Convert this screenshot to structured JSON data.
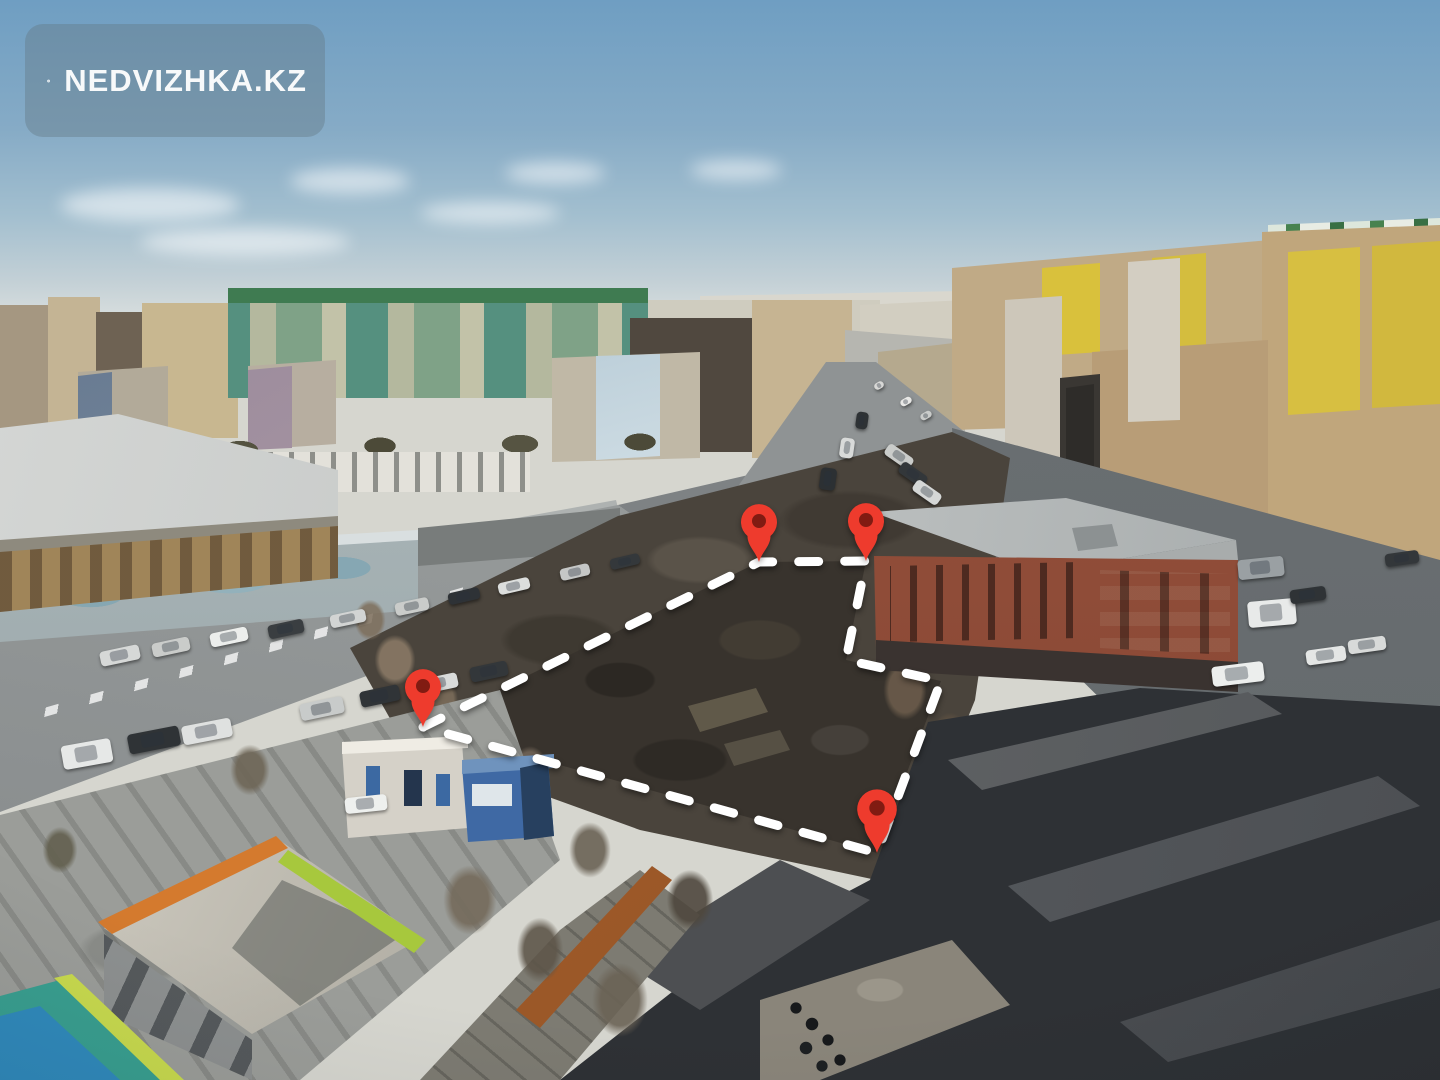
{
  "watermark": {
    "brand_text": "NEDVIZHKA.KZ",
    "icon": "house-icon"
  },
  "plot_overlay": {
    "outline_color": "#ffffff",
    "outline_style": "dashed",
    "stroke_width": 9,
    "dash_pattern": [
      20,
      26
    ],
    "points": [
      [
        423,
        727
      ],
      [
        759,
        562
      ],
      [
        866,
        561
      ],
      [
        846,
        660
      ],
      [
        941,
        681
      ],
      [
        877,
        853
      ]
    ],
    "closed": true,
    "pins": [
      {
        "name": "pin-top-left",
        "x": 759,
        "y": 562,
        "scale": 1.0
      },
      {
        "name": "pin-top-right",
        "x": 866,
        "y": 561,
        "scale": 1.0
      },
      {
        "name": "pin-left",
        "x": 423,
        "y": 727,
        "scale": 1.0
      },
      {
        "name": "pin-bottom",
        "x": 877,
        "y": 853,
        "scale": 1.1
      }
    ]
  },
  "palette": {
    "sky-top": "#6f9ec2",
    "sky-mid": "#a3bfcf",
    "sky-horizon": "#e7e8e3",
    "road": "#8b8f90",
    "road-lit": "#9fa3a2",
    "road-dark": "#63686b",
    "ground": "#4a443c",
    "plot-ground": "#38332d",
    "brick": "#8f4c38",
    "brick-roof": "#b9bdbd",
    "garage-dark": "#2e3135",
    "garage-roof": "#63666a",
    "pin": "#ee3b2d",
    "pin-hole": "#811b12",
    "dash": "#ffffff",
    "panel": "rgba(101,121,134,0.42)",
    "brand-text": "#f7f9fa"
  },
  "cars": [
    {
      "x": 62,
      "y": 742,
      "w": 50,
      "h": 24,
      "angle": -10,
      "color": "#e6e8e7"
    },
    {
      "x": 128,
      "y": 730,
      "w": 52,
      "h": 20,
      "angle": -11,
      "color": "#2f3336"
    },
    {
      "x": 182,
      "y": 722,
      "w": 50,
      "h": 19,
      "angle": -11,
      "color": "#dfe1e0"
    },
    {
      "x": 300,
      "y": 700,
      "w": 44,
      "h": 17,
      "angle": -12,
      "color": "#c8cbca"
    },
    {
      "x": 360,
      "y": 688,
      "w": 40,
      "h": 16,
      "angle": -12,
      "color": "#303437"
    },
    {
      "x": 418,
      "y": 676,
      "w": 40,
      "h": 15,
      "angle": -12,
      "color": "#d9dbda"
    },
    {
      "x": 470,
      "y": 664,
      "w": 38,
      "h": 15,
      "angle": -12,
      "color": "#33373a"
    },
    {
      "x": 100,
      "y": 648,
      "w": 40,
      "h": 15,
      "angle": -12,
      "color": "#d6d8d7"
    },
    {
      "x": 152,
      "y": 640,
      "w": 38,
      "h": 14,
      "angle": -12,
      "color": "#caccca"
    },
    {
      "x": 210,
      "y": 630,
      "w": 38,
      "h": 14,
      "angle": -12,
      "color": "#eceeec"
    },
    {
      "x": 268,
      "y": 622,
      "w": 36,
      "h": 14,
      "angle": -12,
      "color": "#3a3e41"
    },
    {
      "x": 330,
      "y": 612,
      "w": 36,
      "h": 13,
      "angle": -12,
      "color": "#d2d4d3"
    },
    {
      "x": 395,
      "y": 600,
      "w": 34,
      "h": 13,
      "angle": -12,
      "color": "#caccca"
    },
    {
      "x": 448,
      "y": 590,
      "w": 32,
      "h": 12,
      "angle": -13,
      "color": "#2e3236"
    },
    {
      "x": 498,
      "y": 580,
      "w": 32,
      "h": 12,
      "angle": -13,
      "color": "#dcdedd"
    },
    {
      "x": 560,
      "y": 566,
      "w": 30,
      "h": 12,
      "angle": -13,
      "color": "#c5c7c6"
    },
    {
      "x": 610,
      "y": 556,
      "w": 30,
      "h": 11,
      "angle": -13,
      "color": "#34383b"
    },
    {
      "x": 820,
      "y": 468,
      "w": 16,
      "h": 22,
      "angle": 8,
      "color": "#2c3033"
    },
    {
      "x": 840,
      "y": 438,
      "w": 14,
      "h": 20,
      "angle": 8,
      "color": "#d8dad9"
    },
    {
      "x": 856,
      "y": 412,
      "w": 12,
      "h": 17,
      "angle": 8,
      "color": "#2e3235"
    },
    {
      "x": 874,
      "y": 382,
      "w": 10,
      "h": 7,
      "angle": -30,
      "color": "#d8d8d6"
    },
    {
      "x": 900,
      "y": 398,
      "w": 12,
      "h": 7,
      "angle": -30,
      "color": "#e8e8e6"
    },
    {
      "x": 920,
      "y": 412,
      "w": 12,
      "h": 7,
      "angle": -30,
      "color": "#caccca"
    },
    {
      "x": 884,
      "y": 450,
      "w": 30,
      "h": 13,
      "angle": 35,
      "color": "#caccca"
    },
    {
      "x": 898,
      "y": 468,
      "w": 30,
      "h": 13,
      "angle": 35,
      "color": "#33373a"
    },
    {
      "x": 912,
      "y": 486,
      "w": 30,
      "h": 13,
      "angle": 35,
      "color": "#d5d7d6"
    },
    {
      "x": 345,
      "y": 796,
      "w": 42,
      "h": 16,
      "angle": -6,
      "color": "#eef0ee"
    },
    {
      "x": 1238,
      "y": 558,
      "w": 46,
      "h": 20,
      "angle": -6,
      "color": "#9aa0a3"
    },
    {
      "x": 1248,
      "y": 600,
      "w": 48,
      "h": 26,
      "angle": -5,
      "color": "#e8eae9"
    },
    {
      "x": 1212,
      "y": 664,
      "w": 52,
      "h": 20,
      "angle": -7,
      "color": "#eceeed"
    },
    {
      "x": 1306,
      "y": 648,
      "w": 40,
      "h": 15,
      "angle": -8,
      "color": "#e4e6e5"
    },
    {
      "x": 1348,
      "y": 638,
      "w": 38,
      "h": 14,
      "angle": -8,
      "color": "#d8dad9"
    },
    {
      "x": 1290,
      "y": 588,
      "w": 36,
      "h": 14,
      "angle": -8,
      "color": "#2f3336"
    },
    {
      "x": 1385,
      "y": 552,
      "w": 34,
      "h": 13,
      "angle": -8,
      "color": "#33373a"
    }
  ]
}
